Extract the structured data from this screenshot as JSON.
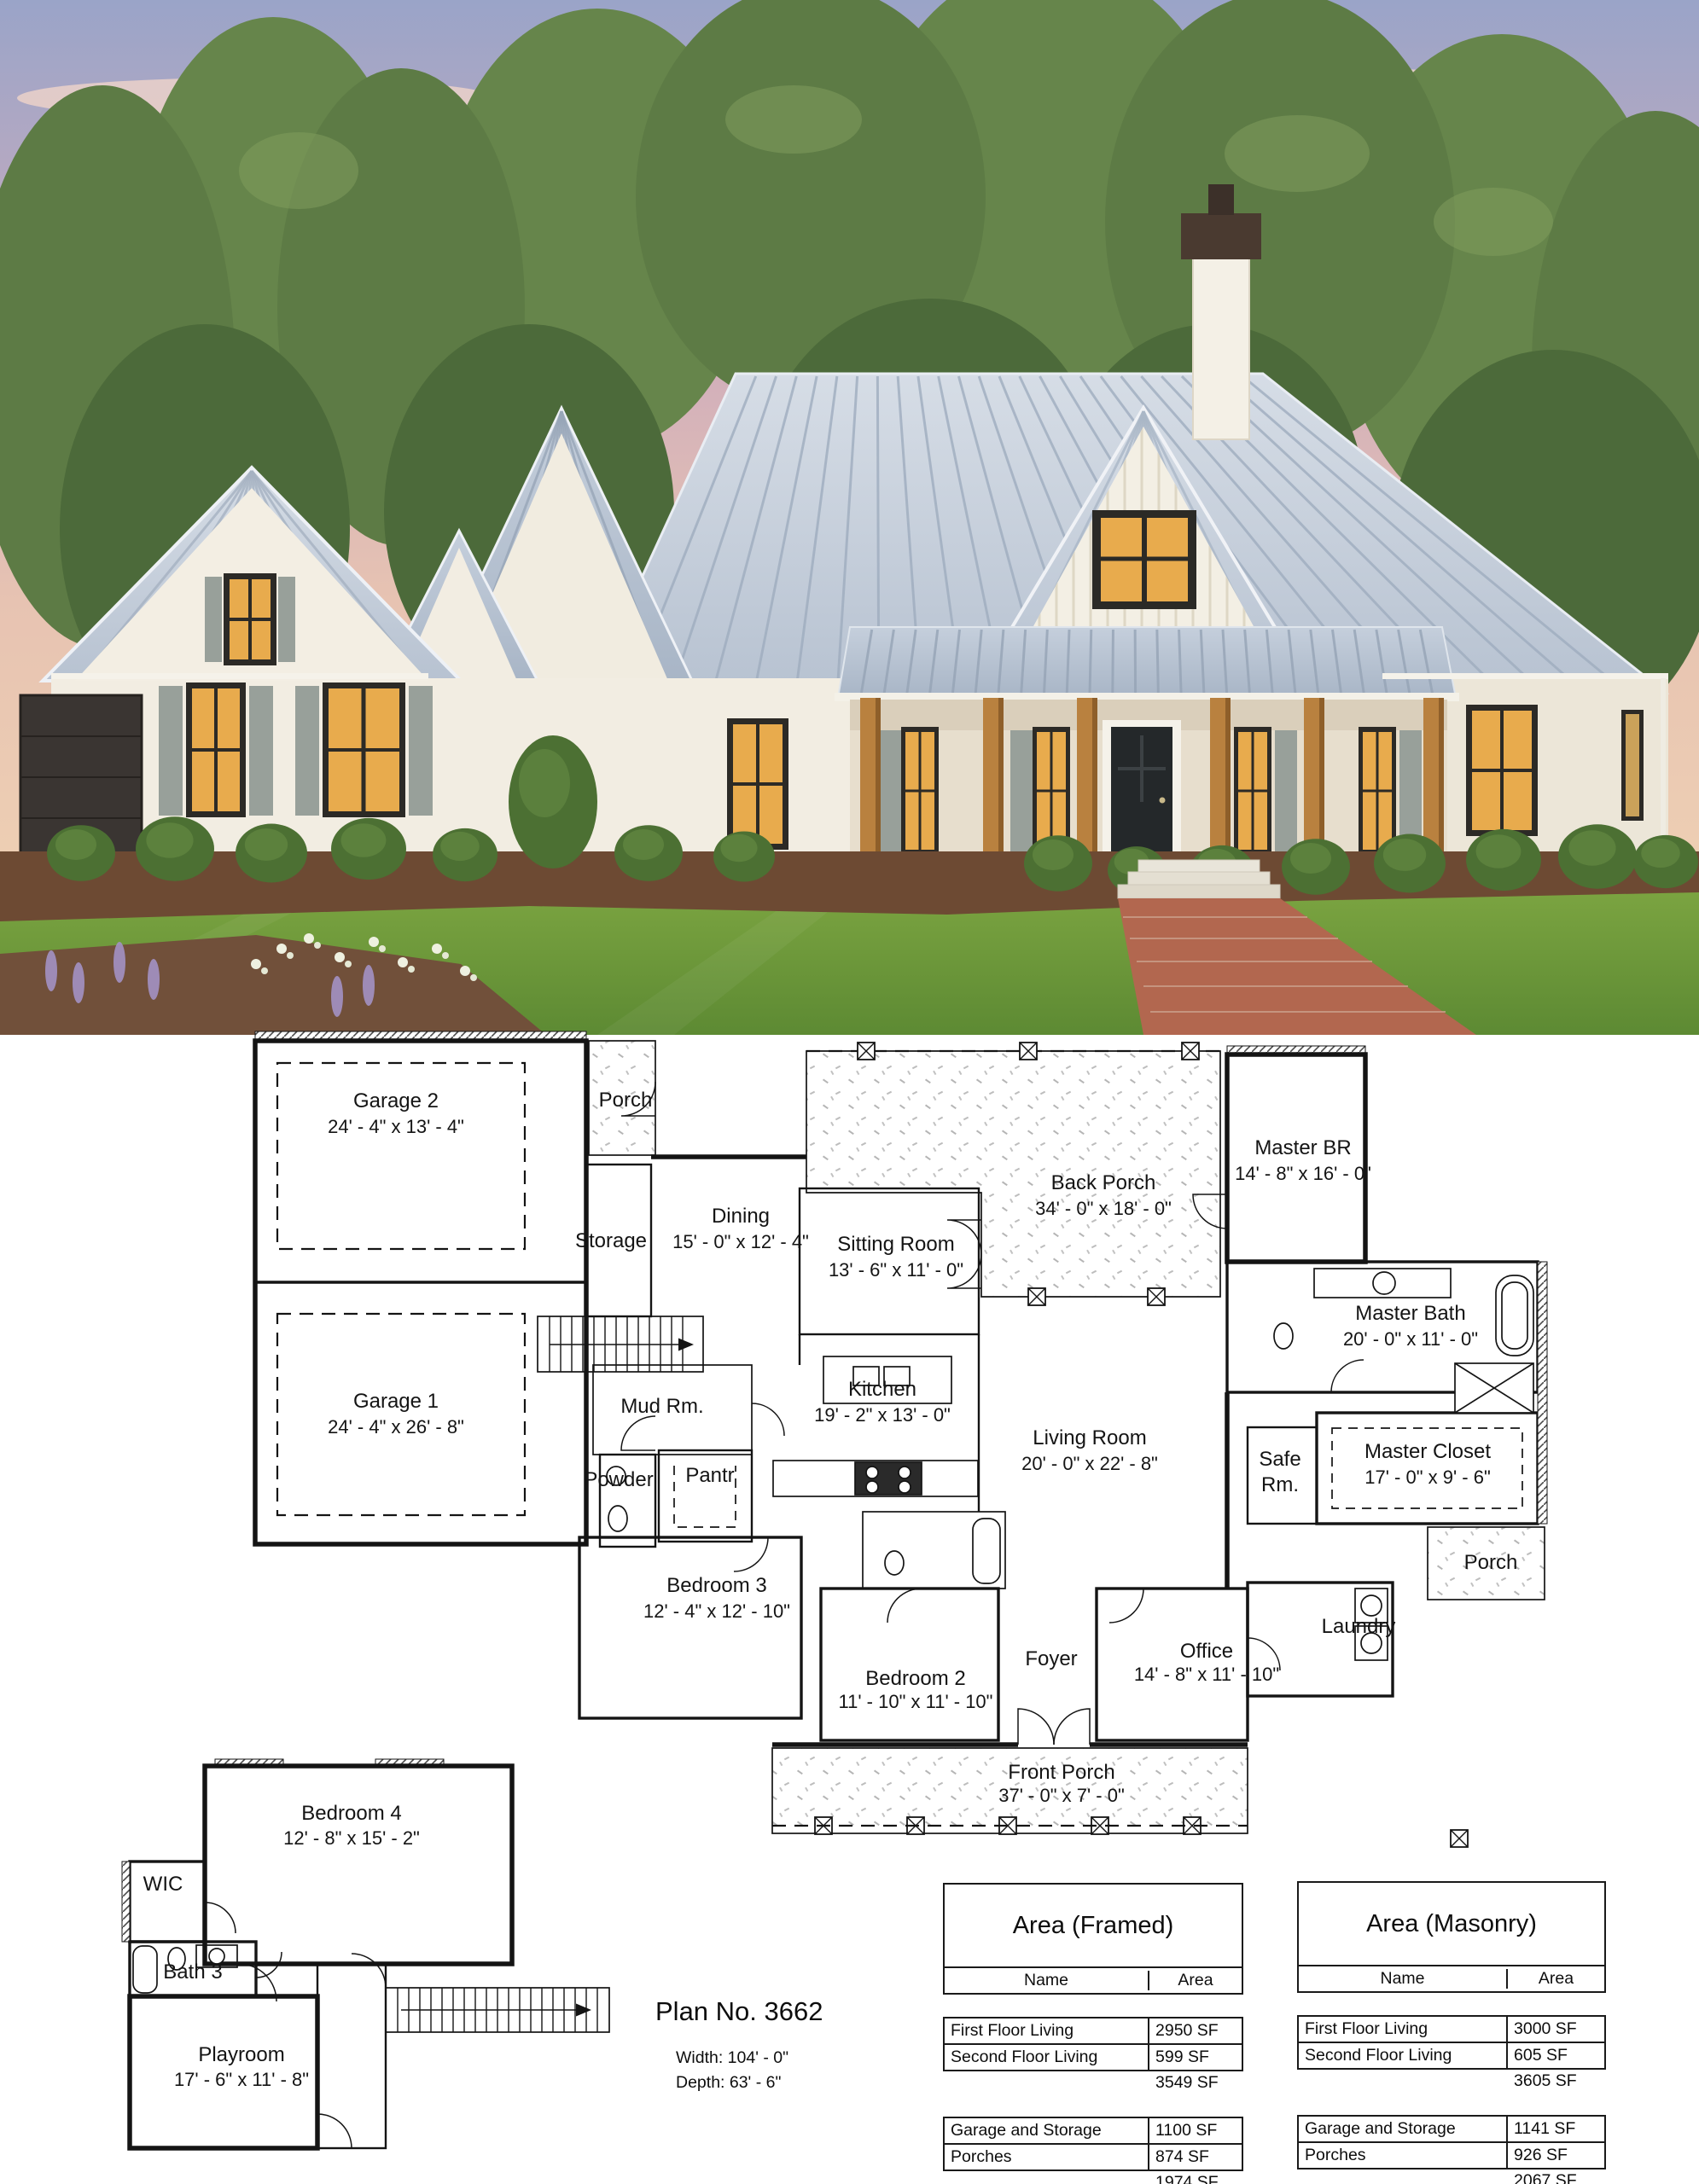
{
  "photo": {
    "palette": {
      "sky_top": "#9aa4c8",
      "sky_pink": "#dfb6bb",
      "sky_horizon": "#f2d6b4",
      "cloud": "#f4d7c9",
      "foliage": "#5d7b45",
      "foliage_dark": "#4c6a3a",
      "roof": "#c7d0dc",
      "roof_seam": "#9fadbf",
      "wall": "#f2ede2",
      "window_glow": "#e8ab4d",
      "window_frame": "#2c2a26",
      "shutter": "#98a09a",
      "wood_post": "#b9813f",
      "front_door": "#24282a",
      "garage_door": "#3a3532",
      "lawn": "#7aa43e",
      "mulch": "#6d4a33",
      "walkway_brick": "#b2674f"
    }
  },
  "floor_plan": {
    "first_floor": {
      "rooms": [
        {
          "id": "garage-2",
          "name": "Garage 2",
          "dims": "24' - 4\" x 13' - 4\""
        },
        {
          "id": "garage-1",
          "name": "Garage 1",
          "dims": "24' - 4\" x 26' - 8\""
        },
        {
          "id": "porch-top",
          "name": "Porch",
          "dims": ""
        },
        {
          "id": "storage",
          "name": "Storage",
          "dims": ""
        },
        {
          "id": "dining",
          "name": "Dining",
          "dims": "15' - 0\" x 12' - 4\""
        },
        {
          "id": "sitting-room",
          "name": "Sitting Room",
          "dims": "13' - 6\" x 11' - 0\""
        },
        {
          "id": "back-porch",
          "name": "Back Porch",
          "dims": "34' - 0\" x 18' - 0\""
        },
        {
          "id": "master-br",
          "name": "Master BR",
          "dims": "14' - 8\" x 16' - 0\""
        },
        {
          "id": "master-bath",
          "name": "Master Bath",
          "dims": "20' - 0\" x 11' - 0\""
        },
        {
          "id": "master-closet",
          "name": "Master Closet",
          "dims": "17' - 0\" x 9' - 6\""
        },
        {
          "id": "safe-rm",
          "name": "Safe Rm.",
          "dims": ""
        },
        {
          "id": "mud-rm",
          "name": "Mud Rm.",
          "dims": ""
        },
        {
          "id": "powder",
          "name": "Powder",
          "dims": ""
        },
        {
          "id": "pantry",
          "name": "Pantr",
          "dims": ""
        },
        {
          "id": "kitchen",
          "name": "Kitchen",
          "dims": "19' - 2\" x 13' - 0\""
        },
        {
          "id": "living-room",
          "name": "Living Room",
          "dims": "20' - 0\" x 22' - 8\""
        },
        {
          "id": "bedroom-3",
          "name": "Bedroom 3",
          "dims": "12' - 4\" x 12' - 10\""
        },
        {
          "id": "bedroom-2",
          "name": "Bedroom 2",
          "dims": "11' - 10\" x 11' - 10\""
        },
        {
          "id": "foyer",
          "name": "Foyer",
          "dims": ""
        },
        {
          "id": "office",
          "name": "Office",
          "dims": "14' - 8\" x 11' - 10\""
        },
        {
          "id": "laundry",
          "name": "Laundry",
          "dims": ""
        },
        {
          "id": "porch-right",
          "name": "Porch",
          "dims": ""
        },
        {
          "id": "front-porch",
          "name": "Front Porch",
          "dims": "37' - 0\" x 7' - 0\""
        }
      ]
    },
    "second_floor": {
      "rooms": [
        {
          "id": "bedroom-4",
          "name": "Bedroom 4",
          "dims": "12' - 8\" x 15' - 2\""
        },
        {
          "id": "wic",
          "name": "WIC",
          "dims": ""
        },
        {
          "id": "bath-3",
          "name": "Bath 3",
          "dims": ""
        },
        {
          "id": "playroom",
          "name": "Playroom",
          "dims": "17' - 6\" x 11' - 8\""
        }
      ]
    }
  },
  "plan_info": {
    "title": "Plan No. 3662",
    "width": "Width: 104' - 0\"",
    "depth": "Depth: 63' - 6\""
  },
  "area_tables": [
    {
      "id": "framed",
      "title": "Area (Framed)",
      "columns": [
        "Name",
        "Area"
      ],
      "groups": [
        {
          "rows": [
            [
              "First Floor Living",
              "2950 SF"
            ],
            [
              "Second Floor Living",
              "599 SF"
            ]
          ],
          "subtotal": "3549 SF"
        },
        {
          "rows": [
            [
              "Garage and Storage",
              "1100 SF"
            ],
            [
              "Porches",
              "874 SF"
            ]
          ],
          "subtotal": "1974 SF"
        }
      ],
      "total_label": "Grand total",
      "total_value": "5523 SF"
    },
    {
      "id": "masonry",
      "title": "Area (Masonry)",
      "columns": [
        "Name",
        "Area"
      ],
      "groups": [
        {
          "rows": [
            [
              "First Floor Living",
              "3000 SF"
            ],
            [
              "Second Floor Living",
              "605 SF"
            ]
          ],
          "subtotal": "3605 SF"
        },
        {
          "rows": [
            [
              "Garage and Storage",
              "1141 SF"
            ],
            [
              "Porches",
              "926 SF"
            ]
          ],
          "subtotal": "2067 SF"
        }
      ],
      "total_label": "Total SF",
      "total_value": "5672 SF"
    }
  ]
}
